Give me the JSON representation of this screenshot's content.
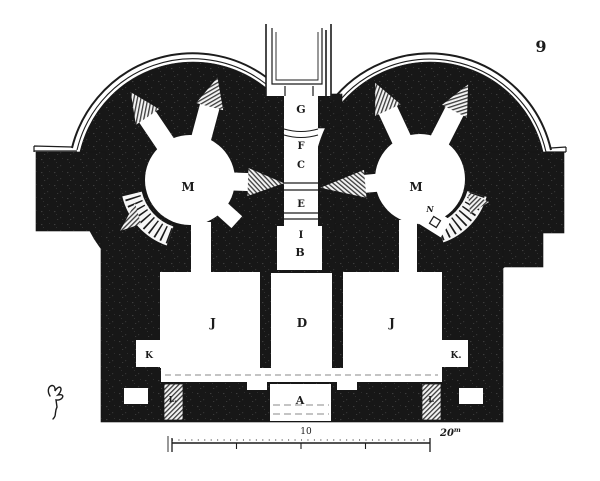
{
  "figure": {
    "number": "9"
  },
  "palette": {
    "ink": "#1a1a1a",
    "paper": "#ffffff",
    "hatch": "#3c3c3c"
  },
  "plan": {
    "corridor": {
      "g": "G",
      "f": "F",
      "c": "C",
      "e": "E",
      "i": "I",
      "b": "B"
    },
    "rooms": {
      "d": "D",
      "a": "A",
      "j": "J",
      "k_left": "K",
      "k_right": "K.",
      "l_left": "L.",
      "l_right": "L",
      "m": "M",
      "n": "N"
    },
    "scale_bar": {
      "mid_value": "10",
      "end_value": "20",
      "unit": "m"
    }
  }
}
